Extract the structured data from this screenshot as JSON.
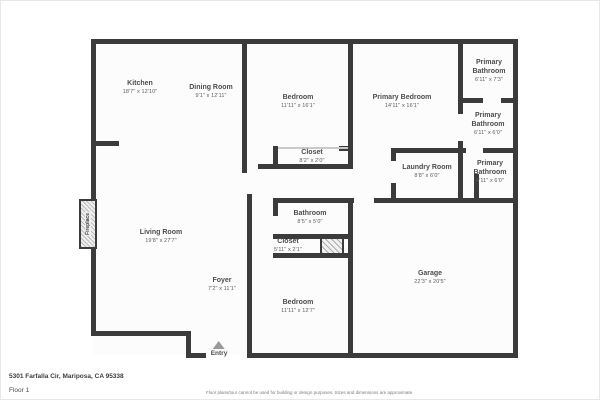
{
  "labels": {
    "address": "5301 Farfalla Cir, Mariposa, CA 95338",
    "floor": "Floor 1",
    "disclaimer": "Floor plans/tour cannot be used for building or design purposes. Sizes and dimensions are approximate.",
    "entry": "Entry",
    "fireplace": "Fireplace"
  },
  "colors": {
    "wall": "#3b3b3b",
    "window_marker": "#dcdcdc",
    "garage_door_marker": "#e4e4e4",
    "floor_fill": "#fcfcfc",
    "text": "#4c4c4c"
  },
  "floorplan": {
    "rooms": [
      {
        "id": "kitchen",
        "name": "Kitchen",
        "dims": "18'7\" x 12'10\"",
        "x": 139,
        "y": 87
      },
      {
        "id": "dining-room",
        "name": "Dining Room",
        "dims": "9'1\" x 12'11\"",
        "x": 210,
        "y": 91
      },
      {
        "id": "bedroom-1",
        "name": "Bedroom",
        "dims": "11'11\" x 16'1\"",
        "x": 297,
        "y": 101
      },
      {
        "id": "primary-bedroom",
        "name": "Primary Bedroom",
        "dims": "14'11\" x 16'1\"",
        "x": 401,
        "y": 101
      },
      {
        "id": "primary-bathroom-1",
        "name": "Primary Bathroom",
        "dims": "6'11\" x 7'3\"",
        "x": 488,
        "y": 70,
        "w": 48
      },
      {
        "id": "primary-bathroom-2",
        "name": "Primary Bathroom",
        "dims": "6'11\" x 6'0\"",
        "x": 487,
        "y": 123,
        "w": 48
      },
      {
        "id": "primary-bathroom-3",
        "name": "Primary Bathroom",
        "dims": "6'11\" x 6'0\"",
        "x": 489,
        "y": 171,
        "w": 48
      },
      {
        "id": "closet-1",
        "name": "Closet",
        "dims": "8'2\" x 2'0\"",
        "x": 311,
        "y": 156
      },
      {
        "id": "laundry-room",
        "name": "Laundry Room",
        "dims": "8'8\" x 6'0\"",
        "x": 426,
        "y": 171
      },
      {
        "id": "living-room",
        "name": "Living Room",
        "dims": "19'8\" x 27'7\"",
        "x": 160,
        "y": 236
      },
      {
        "id": "bathroom",
        "name": "Bathroom",
        "dims": "8'5\" x 5'0\"",
        "x": 309,
        "y": 217
      },
      {
        "id": "closet-2",
        "name": "Closet",
        "dims": "5'11\" x 2'1\"",
        "x": 287,
        "y": 245
      },
      {
        "id": "foyer",
        "name": "Foyer",
        "dims": "7'2\" x 11'1\"",
        "x": 221,
        "y": 284
      },
      {
        "id": "bedroom-2",
        "name": "Bedroom",
        "dims": "11'11\" x 12'7\"",
        "x": 297,
        "y": 306
      },
      {
        "id": "garage",
        "name": "Garage",
        "dims": "22'3\" x 20'5\"",
        "x": 429,
        "y": 277
      }
    ],
    "floor_rects": [
      [
        92,
        40,
        423,
        314
      ]
    ],
    "walls": [
      [
        92,
        38,
        425,
        5
      ],
      [
        90,
        38,
        5,
        297
      ],
      [
        512,
        38,
        5,
        319
      ],
      [
        90,
        330,
        100,
        5
      ],
      [
        185,
        330,
        5,
        27
      ],
      [
        185,
        352,
        20,
        5
      ],
      [
        246,
        352,
        271,
        5
      ],
      [
        90,
        140,
        28,
        5
      ],
      [
        241,
        38,
        5,
        134
      ],
      [
        246,
        193,
        5,
        164
      ],
      [
        347,
        38,
        5,
        130
      ],
      [
        272,
        145,
        5,
        23
      ],
      [
        338,
        145,
        14,
        5
      ],
      [
        257,
        163,
        95,
        5
      ],
      [
        390,
        147,
        72,
        5
      ],
      [
        390,
        147,
        5,
        13
      ],
      [
        390,
        182,
        5,
        15
      ],
      [
        457,
        38,
        5,
        75
      ],
      [
        457,
        140,
        5,
        62
      ],
      [
        457,
        97,
        25,
        5
      ],
      [
        500,
        97,
        17,
        5
      ],
      [
        457,
        147,
        8,
        5
      ],
      [
        482,
        147,
        35,
        5
      ],
      [
        473,
        173,
        5,
        24
      ],
      [
        272,
        197,
        81,
        5
      ],
      [
        373,
        197,
        144,
        5
      ],
      [
        272,
        202,
        5,
        13
      ],
      [
        272,
        233,
        5,
        5
      ],
      [
        272,
        233,
        75,
        5
      ],
      [
        272,
        252,
        75,
        5
      ],
      [
        347,
        197,
        5,
        160
      ]
    ],
    "windows": [
      [
        127,
        38,
        30,
        5
      ],
      [
        195,
        38,
        43,
        5
      ],
      [
        278,
        38,
        35,
        5
      ],
      [
        382,
        38,
        41,
        5
      ],
      [
        512,
        107,
        5,
        32
      ],
      [
        512,
        157,
        5,
        35
      ],
      [
        90,
        157,
        5,
        28
      ],
      [
        135,
        330,
        47,
        5
      ],
      [
        273,
        352,
        42,
        5
      ]
    ],
    "garage_doors": [
      [
        363,
        352,
        137,
        5
      ]
    ],
    "sliders": [
      [
        277,
        146,
        70,
        2
      ]
    ],
    "hatches": [
      [
        319,
        236,
        24,
        18
      ]
    ]
  }
}
